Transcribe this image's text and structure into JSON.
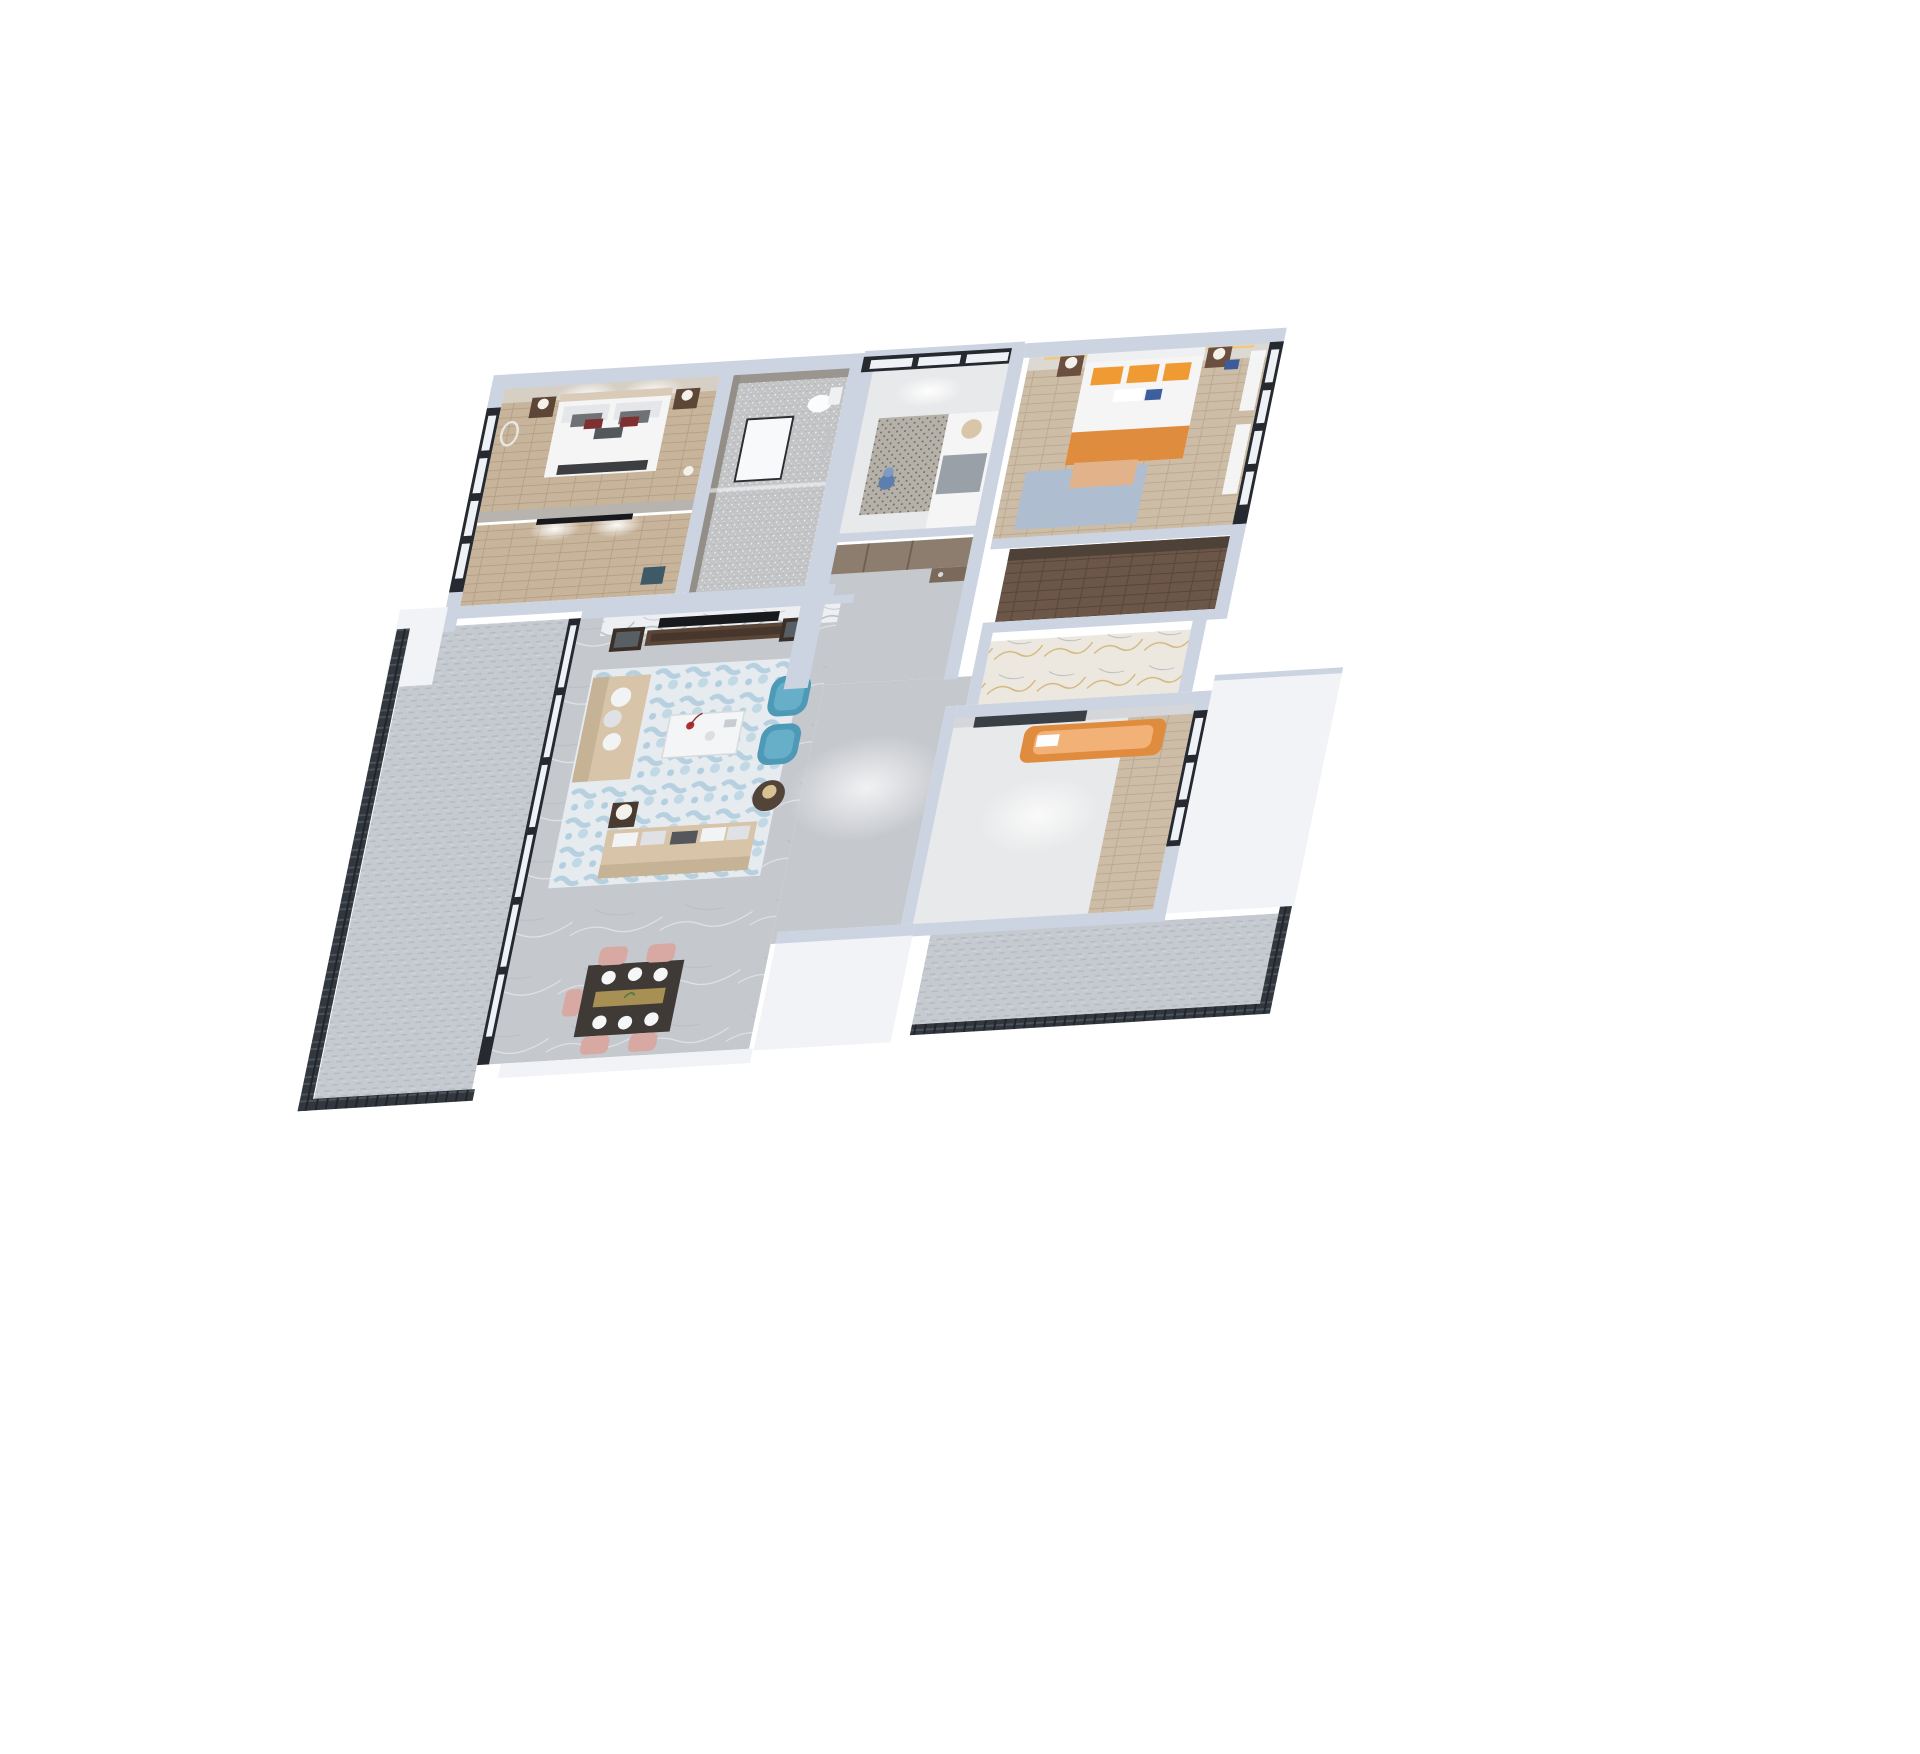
{
  "scene": {
    "title": "3D dollhouse render of a three-bedroom apartment floor plan",
    "view": "axonometric top-down cutaway on white background",
    "background": "#ffffff"
  },
  "colors": {
    "background": "#ffffff",
    "wall": "#ccd4e2",
    "wallLight": "#dde3ee",
    "wallWhite": "#f1f3f7",
    "wallGray": "#b7b3ae",
    "frameDark": "#262a30",
    "glassPane": "#eef2f6",
    "curtain": "#f6f8fa",
    "woodWarm": "#c7b49a",
    "woodBed2": "#cdbca6",
    "woodDark": "#6b5647",
    "floorMarble": "#c5c8cd",
    "floorLight": "#e8e9ea",
    "sparkleBase": "#c2c4c6",
    "carpetBase": "#c5cad0",
    "railing": "#32373e",
    "marbleGold": "#ece7df",
    "veinGold": "#c9a254",
    "bedWhite": "#f5f5f6",
    "beige": "#d8c4a8",
    "beigeDark": "#c6b295",
    "blueChair": "#4e9ab6",
    "blueChairLight": "#67aec8",
    "blueRug": "#8db9d2",
    "bedroom2Rug": "#aebdd0",
    "orange": "#f09a33",
    "orangeBed": "#e08c3e",
    "pink": "#d7a9a2",
    "tvBlack": "#17191d",
    "brownDoor": "#7b6a5c",
    "cabinetBrown": "#8d7d6e",
    "nightstand": "#5e4637",
    "redAccent": "#7e3030",
    "lampWhite": "#f3f1ea",
    "toyBlue": "#5d7fb0",
    "pillowGray": "#6e7176",
    "darkPanel": "#3a3f45",
    "tableDark": "#3f3a36",
    "goldRunner": "#b49a58"
  },
  "rooms": [
    {
      "id": "master-bedroom",
      "label": "Master Bedroom",
      "floor": "light wood",
      "furniture": [
        "double bed with grey pillows and red accents",
        "two nightstands",
        "table lamps",
        "ring wall light",
        "floor lamp",
        "spotlit headboard wall"
      ]
    },
    {
      "id": "master-tv-room",
      "label": "Master TV Nook",
      "floor": "light wood",
      "furniture": [
        "wall-mounted TV",
        "accent chair"
      ]
    },
    {
      "id": "bathroom",
      "label": "Bathroom",
      "floor": "sparkle grey tile",
      "furniture": [
        "toilet",
        "framed mirror",
        "shower set",
        "glass screen"
      ]
    },
    {
      "id": "kids-room",
      "label": "Small Bedroom / Study",
      "floor": "pale wood",
      "furniture": [
        "daybed",
        "patterned rug",
        "blue toy figure",
        "black-framed picture window"
      ]
    },
    {
      "id": "entry-hall",
      "label": "Entry Hall",
      "floor": "grey marble",
      "furniture": [
        "wardrobe cabinets",
        "wooden entry door with chrome handle"
      ]
    },
    {
      "id": "bedroom-2",
      "label": "Bedroom 2",
      "floor": "light wood",
      "furniture": [
        "double bed",
        "orange pillows",
        "orange throw",
        "blue accent cushion",
        "nightstands with white lamps",
        "light blue rug",
        "curtained black-framed windows"
      ]
    },
    {
      "id": "walk-in-closet",
      "label": "Walk-in Closet",
      "floor": "dark wood"
    },
    {
      "id": "ensuite-bathroom",
      "label": "Ensuite Bathroom",
      "floor": "white marble with gold veins"
    },
    {
      "id": "bedroom-3",
      "label": "Bedroom 3",
      "floor": "pale marble with wood strip",
      "furniture": [
        "orange upholstered bed",
        "dark media panel"
      ]
    },
    {
      "id": "living-room",
      "label": "Living Room",
      "floor": "grey marble",
      "furniture": [
        "white marble TV feature wall",
        "TV",
        "dark wood media console",
        "two display cabinets",
        "beige loveseat",
        "beige three-seat sofa",
        "two blue wingback armchairs",
        "white coffee table with red flowers",
        "square side table with lamp",
        "round side table with lamp",
        "abstract blue-white rug"
      ]
    },
    {
      "id": "dining-room",
      "label": "Dining Room",
      "floor": "grey marble",
      "furniture": [
        "dark wood dining table",
        "white place settings",
        "gold runner",
        "pink dining chairs"
      ]
    },
    {
      "id": "balcony-left",
      "label": "Left Balcony",
      "floor": "grey carpet tile",
      "furniture": [
        "dark metal railing",
        "black-framed sliding glass wall"
      ]
    },
    {
      "id": "balcony-right",
      "label": "Right Balcony",
      "floor": "grey carpet tile",
      "furniture": [
        "dark metal railing"
      ]
    }
  ]
}
